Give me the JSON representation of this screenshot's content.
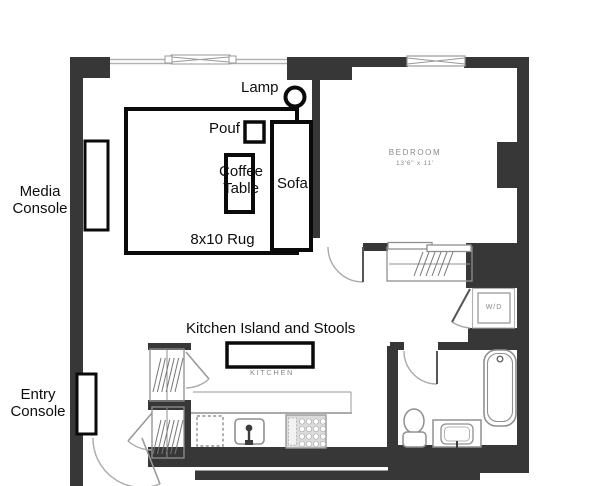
{
  "colors": {
    "wall": "#373737",
    "furniture": "#0a0a0a",
    "fixture": "#8f8f8f",
    "windowline": "#b2b2b2",
    "plantext": "#8a8a8a",
    "labeltext": "#0d0d0d",
    "background": "#ffffff"
  },
  "labels": {
    "media_console": "Media Console",
    "entry_console": "Entry Console",
    "lamp": "Lamp",
    "pouf": "Pouf",
    "coffee_table": "Coffee Table",
    "sofa": "Sofa",
    "rug": "8x10 Rug",
    "kitchen_island": "Kitchen Island and Stools"
  },
  "rooms": {
    "bedroom": {
      "name": "BEDROOM",
      "dimensions": "13'6\" x 11'"
    },
    "kitchen": {
      "name": "KITCHEN"
    },
    "washer_dryer": {
      "name": "W/D"
    }
  }
}
